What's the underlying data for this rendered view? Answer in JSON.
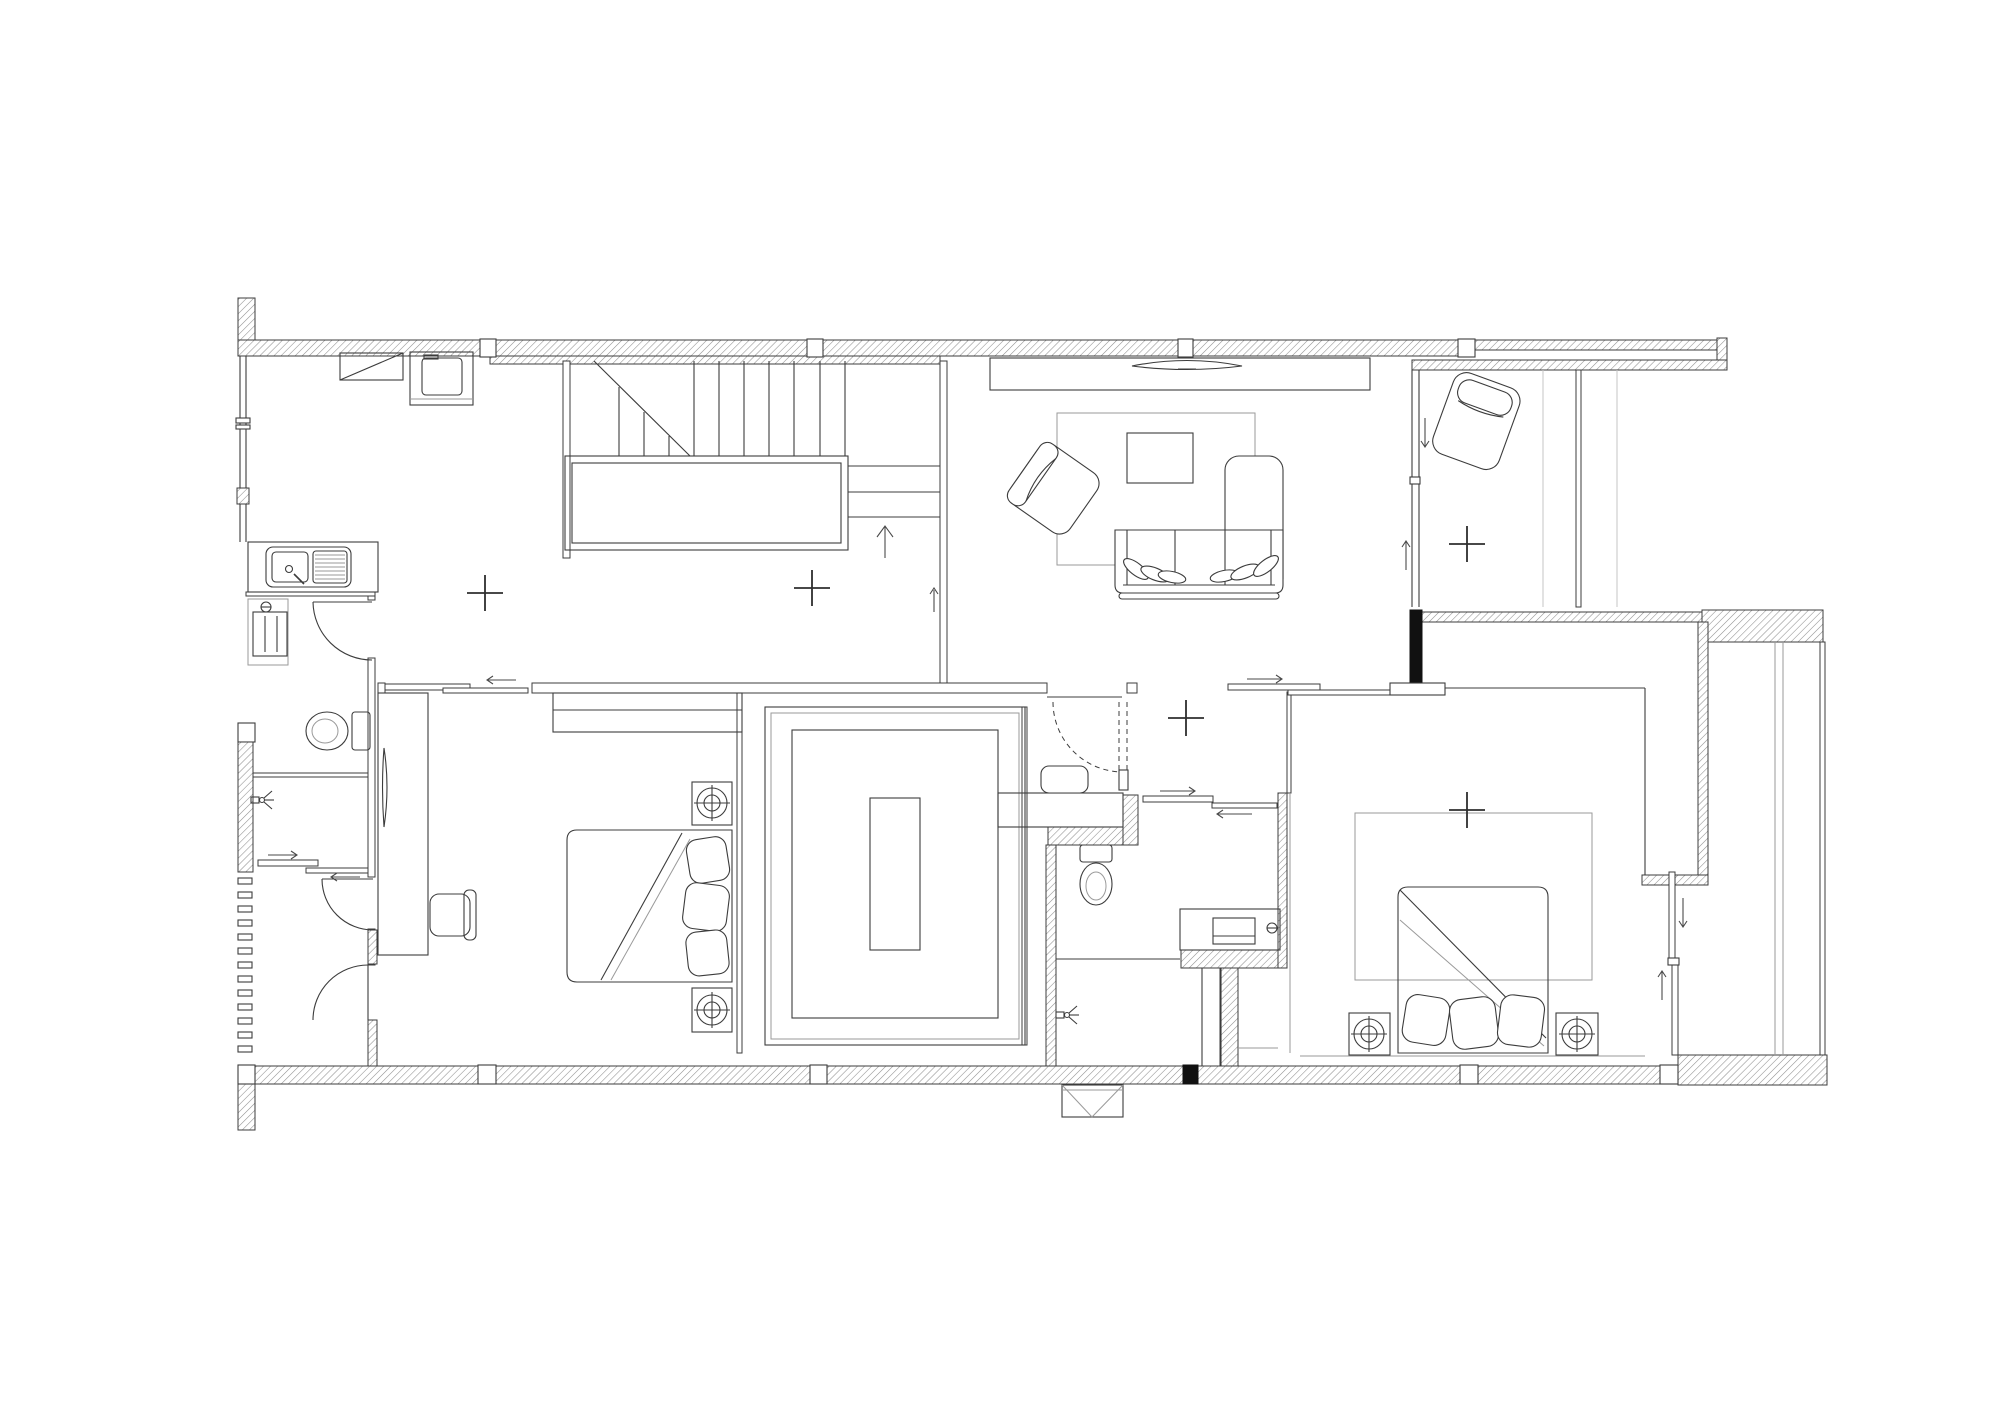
{
  "plan": {
    "kind": "architectural-floor-plan",
    "view": "top-down second-floor plan",
    "drawing_style": "monochrome CAD line drawing with hatched walls",
    "palette": {
      "background": "#ffffff",
      "line_primary": "#3c3c3c",
      "line_light": "#9a9a9a",
      "wall_hatch": "#8f8f8f",
      "solid_black": "#111111"
    },
    "rooms": [
      {
        "name": "kitchen-dining",
        "fixtures": [
          "double-bowl-sink-counter",
          "cooktop",
          "oven-unit",
          "window-wall"
        ]
      },
      {
        "name": "stair-hall",
        "fixtures": [
          "staircase-upper-flight",
          "stair-landing",
          "staircase-lower-flight",
          "up-direction-arrow"
        ]
      },
      {
        "name": "living-room",
        "fixtures": [
          "tv-console",
          "tv",
          "area-rug",
          "coffee-table",
          "armchair",
          "sofa-with-pillows",
          "chaise-lounge"
        ]
      },
      {
        "name": "family-room",
        "fixtures": [
          "lounge-chair",
          "sliding-partition",
          "glass-partition-tracks"
        ]
      },
      {
        "name": "bathroom-1",
        "fixtures": [
          "washing-machine",
          "toilet",
          "shower-head",
          "floor-drain",
          "hinged-door",
          "sliding-door"
        ]
      },
      {
        "name": "bedroom-1",
        "fixtures": [
          "sliding-door",
          "wardrobe",
          "desk-counter",
          "desk-chair",
          "double-bed",
          "nightstand-lamp",
          "nightstand-lamp"
        ]
      },
      {
        "name": "walk-in-closet",
        "fixtures": [
          "u-shaped-wardrobe",
          "island-dresser"
        ]
      },
      {
        "name": "bathroom-2",
        "fixtures": [
          "vanity-counter",
          "vanity-sink",
          "toilet",
          "shower-head",
          "concealed-swing-door",
          "vent-box"
        ]
      },
      {
        "name": "bedroom-2",
        "fixtures": [
          "sliding-entry-door",
          "area-rug",
          "double-bed",
          "nightstand-lamp",
          "nightstand-lamp",
          "dressing-table",
          "sliding-balcony-door"
        ]
      },
      {
        "name": "service-shaft",
        "fixtures": [
          "ledge-lines",
          "perimeter-walls"
        ]
      }
    ],
    "center_marks": [
      {
        "x": 485,
        "y": 593
      },
      {
        "x": 812,
        "y": 588
      },
      {
        "x": 1186,
        "y": 718
      },
      {
        "x": 1467,
        "y": 544
      },
      {
        "x": 1467,
        "y": 810
      }
    ],
    "mark_arm_length": 18
  }
}
